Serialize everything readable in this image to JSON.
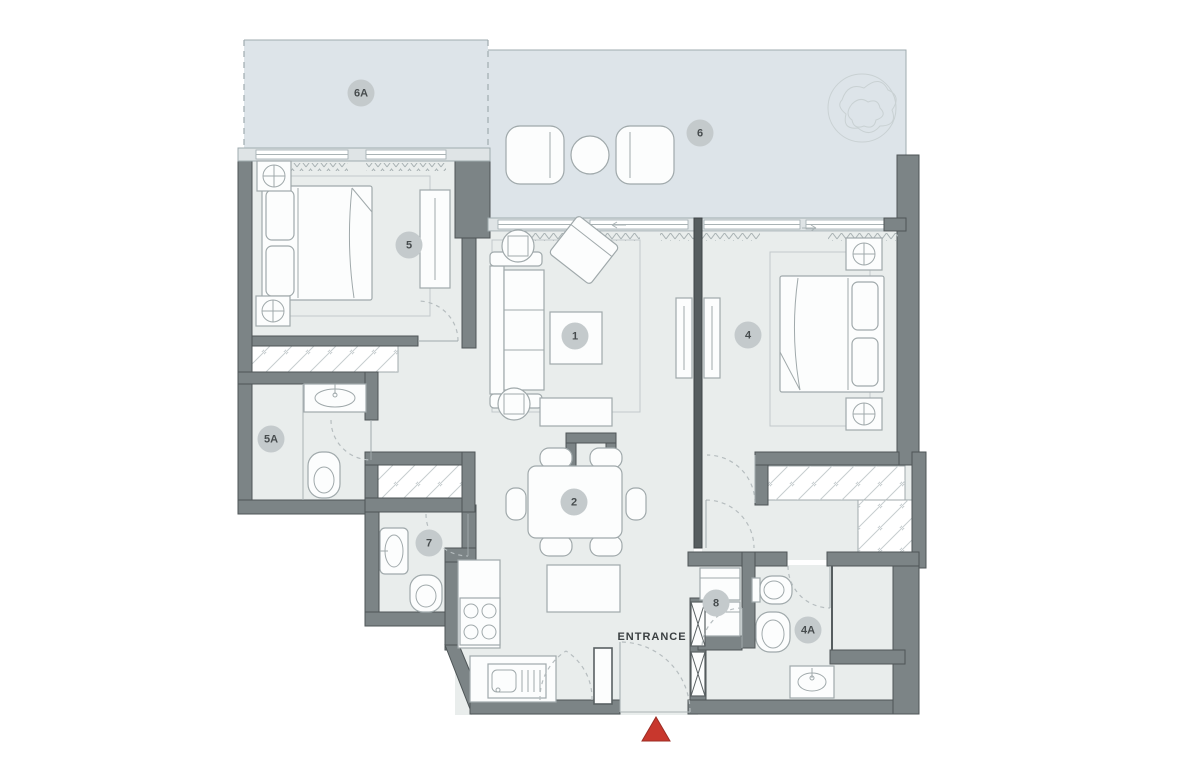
{
  "colors": {
    "page-bg": "#ffffff",
    "balcony-fill": "#dde4e9",
    "floor-fill": "#e9edec",
    "wall-fill": "#7c8486",
    "wall-edge": "#4e5557",
    "wall-dark": "#565d5f",
    "furn-fill": "#fcfdfd",
    "furn-stroke": "#a0a9ab",
    "label-bg": "#c4cacc",
    "label-text": "#474c4e",
    "entrance-red": "#c8372d"
  },
  "labels": {
    "entrance": "ENTRANCE"
  },
  "icons": {
    "entrance_marker": "red-triangle-up",
    "plant": "tree-scribble",
    "lamp": "circle-cross"
  },
  "rooms": [
    {
      "id": "6A"
    },
    {
      "id": "6"
    },
    {
      "id": "5"
    },
    {
      "id": "1"
    },
    {
      "id": "4"
    },
    {
      "id": "5A"
    },
    {
      "id": "2"
    },
    {
      "id": "7"
    },
    {
      "id": "8"
    },
    {
      "id": "4A"
    }
  ]
}
